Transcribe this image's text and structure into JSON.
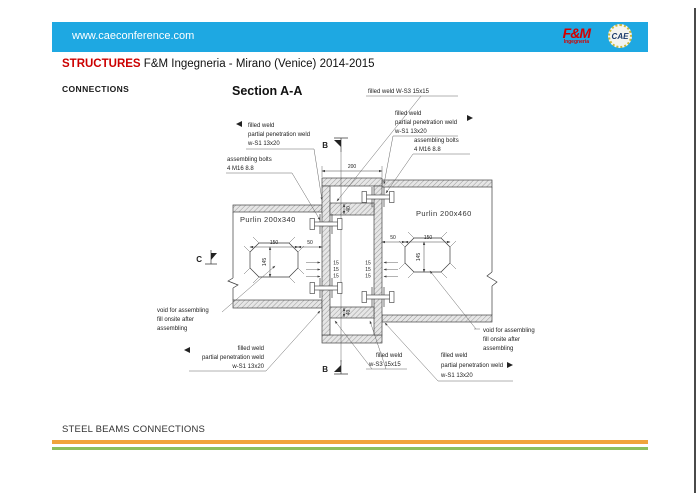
{
  "header": {
    "url": "www.caeconference.com",
    "fm_logo": {
      "top": "F&M",
      "bottom": "Ingegneria"
    },
    "cae_logo": "CAE"
  },
  "titlebar": {
    "brand": "STRUCTURES",
    "subtitle": "F&M Ingegneria - Mirano (Venice) 2014-2015"
  },
  "connections_label": "CONNECTIONS",
  "drawing": {
    "section_title": "Section A-A",
    "purlin_left": "Purlin 200x340",
    "purlin_right": "Purlin 200x460",
    "markers": {
      "b_top": "B",
      "b_bottom": "B",
      "c": "C"
    },
    "ann": {
      "top_weld": "filled weld  W-S3 15x15",
      "left_top_weld": [
        "filled weld",
        "partial penetration weld",
        "w-S1 13x20"
      ],
      "left_bolts": [
        "assembling bolts",
        "4 M16  8.8"
      ],
      "right_top_weld": [
        "filled weld",
        "partial penetration weld",
        "w-S1 13x20"
      ],
      "right_bolts": [
        "assembling bolts",
        "4 M16  8.8"
      ],
      "left_void": [
        "void for assembling",
        "fill onsite after",
        "assembling"
      ],
      "right_void": [
        "void for assembling",
        "fill onsite after",
        "assembling"
      ],
      "left_bottom_weld": [
        "filled weld",
        "partial penetration weld",
        "w-S1 13x20"
      ],
      "bottom_center_weld": [
        "filled weld",
        "w-S3 15x15"
      ],
      "bottom_right_weld": [
        "filled weld",
        "partial penetration weld",
        "w-S1 13x20"
      ]
    },
    "dims": {
      "top_width": "200",
      "diaphragm_top": "40",
      "diaphragm_bottom": "40",
      "left_hole_w": "150",
      "left_hole_h": "145",
      "left_gap": "50",
      "right_hole_w": "150",
      "right_hole_h": "145",
      "right_gap": "50",
      "t1": "15",
      "t2": "15",
      "t3": "15"
    }
  },
  "footer": {
    "text": "STEEL BEAMS CONNECTIONS"
  },
  "colors": {
    "header_blue": "#1EA8E2",
    "brand_red": "#CC0000",
    "logo_red": "#D40000",
    "stripe_orange": "#F0A43C",
    "stripe_green": "#8CBF5E"
  }
}
